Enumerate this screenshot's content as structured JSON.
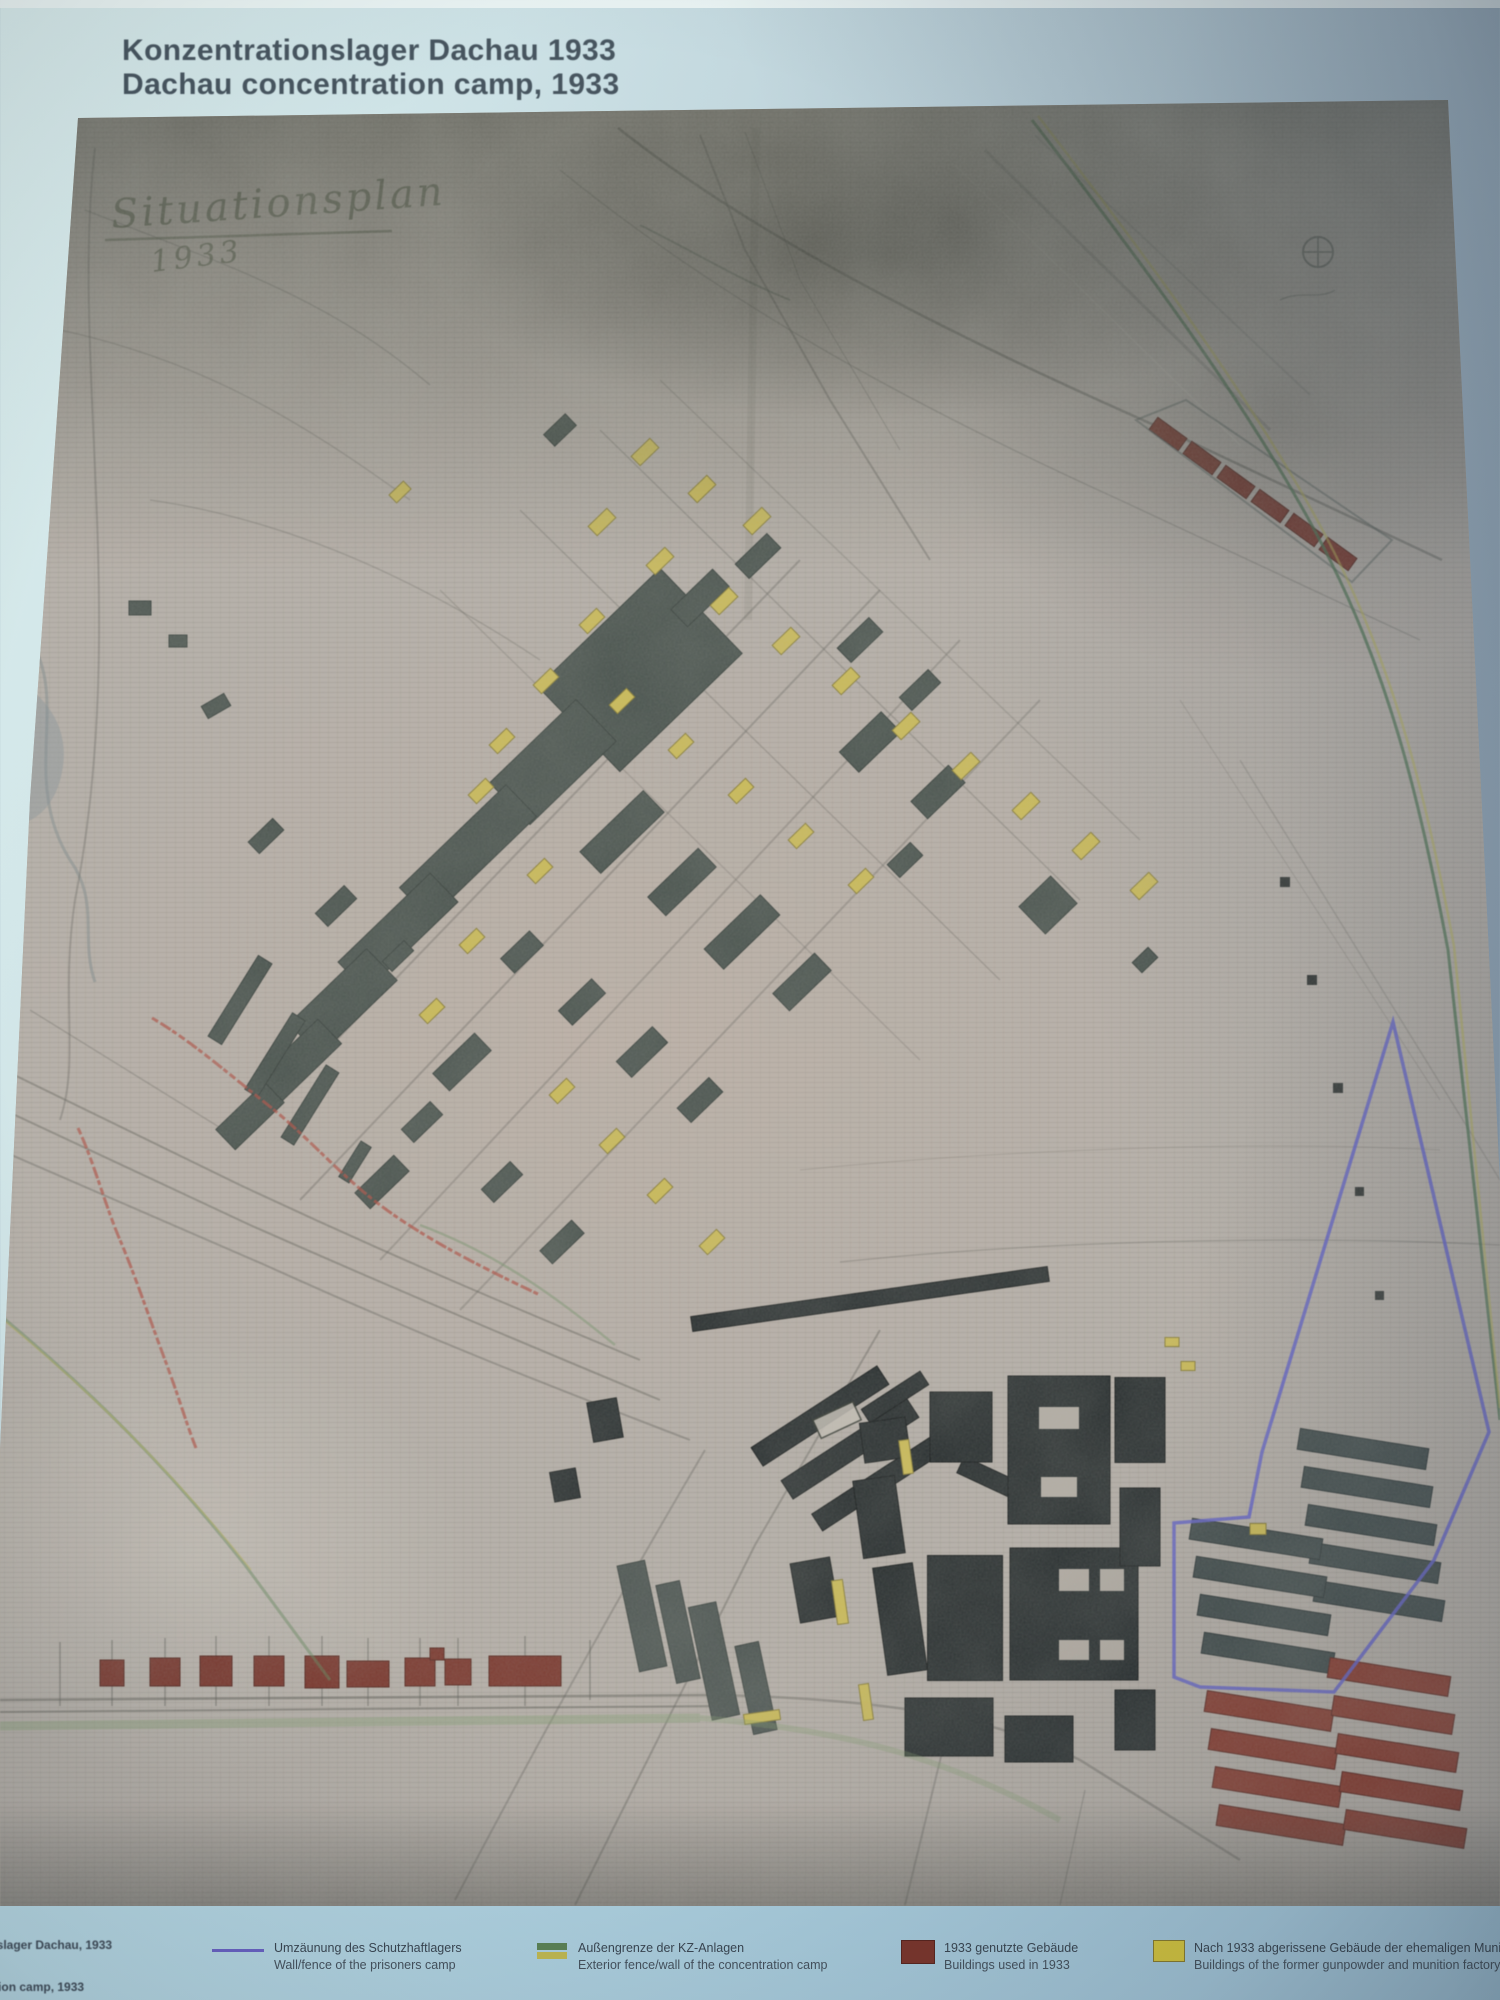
{
  "title": {
    "de": "Konzentrationslager Dachau 1933",
    "en": "Dachau concentration camp, 1933"
  },
  "map_annotations": {
    "handwritten_title": "Situationsplan",
    "handwritten_year": "1933"
  },
  "caption": {
    "de": "Konzentrationslager Dachau, 1933",
    "en": "Dachau concentration camp, 1933"
  },
  "legend": {
    "items": [
      {
        "swatch": "blue-line",
        "color": "#6b63c8",
        "label_de": "Umzäunung des Schutzhaftlagers",
        "label_en": "Wall/fence of the prisoners camp"
      },
      {
        "swatch": "green-yellow-double-line",
        "color_green": "#5d8456",
        "color_yellow": "#c5bd52",
        "label_de": "Außengrenze der KZ-Anlagen",
        "label_en": "Exterior fence/wall of the concentration camp"
      },
      {
        "swatch": "dark-red-rect",
        "color": "#7d352b",
        "label_de": "1933 genutzte Gebäude",
        "label_en": "Buildings used in 1933"
      },
      {
        "swatch": "yellow-rect",
        "color": "#d9c93f",
        "label_de": "Nach 1933 abgerissene Gebäude der ehemaligen Munitionsfabrik",
        "label_en": "Buildings of the former gunpowder and munition factory, torn down"
      }
    ]
  },
  "colors": {
    "panel_blue": "#bcd8e0",
    "paper": "#b7b0a8",
    "building_dark": "#46514c",
    "building_black": "#262c2d",
    "building_red": "#7d3227",
    "building_red_barracks": "#8c392c",
    "building_gray_barracks": "#3e4a4a",
    "building_yellow": "#cdbb4d",
    "camp_wall_blue": "#6060d2",
    "boundary_green": "#47724c",
    "boundary_yellow": "#b9b24a",
    "red_ink": "#b5493c"
  }
}
